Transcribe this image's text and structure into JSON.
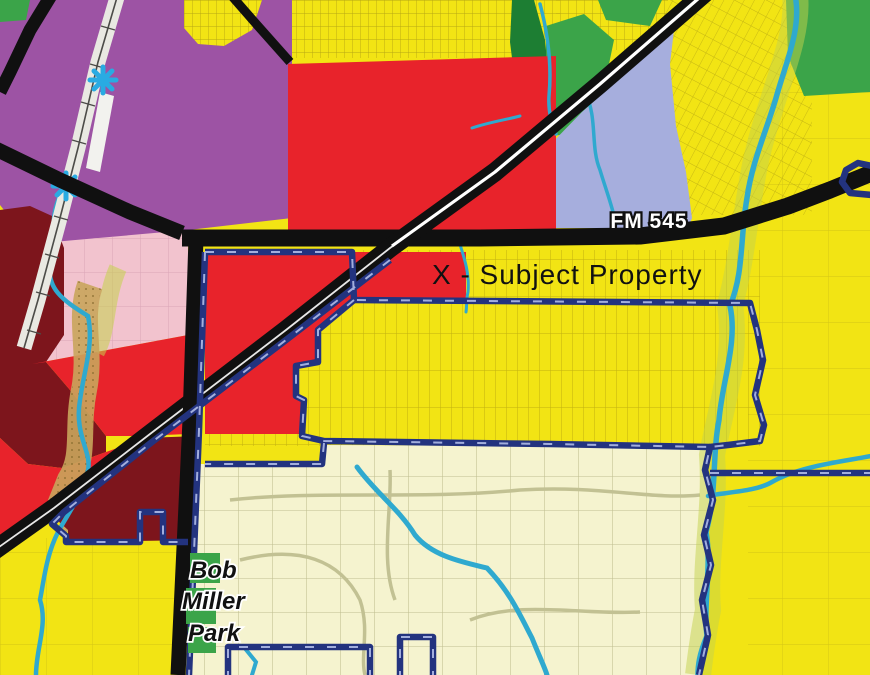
{
  "map": {
    "type": "zoning-land-use-map",
    "labels": {
      "highway": "FM 545",
      "subject": "X - Subject Property",
      "park_line1": "Bob",
      "park_line2": "Miller",
      "park_line3": "Park"
    },
    "markers": {
      "rail_crossing_icon": "blue-asterisk",
      "boundary_style": "navy-dashed-city-limit"
    },
    "colors": {
      "purple": "#9d53a4",
      "red": "#e8232b",
      "maroon": "#7d151c",
      "pink": "#f2c3ce",
      "yellow": "#f2e414",
      "paleYellow": "#f5f3cf",
      "green": "#3ba449",
      "darkGreen": "#1d7e33",
      "periwinkle": "#a6aedd",
      "creek": "#2fa9cf",
      "navy": "#23337f",
      "navyDash": "#b9c4ee",
      "road": "#101010",
      "rail": "#e9e9e2",
      "railLine": "#4c4c48",
      "tan": "#c9a55c",
      "tanDot": "#8a6d2f",
      "floodGreen": "#c4d24b",
      "asterisk": "#29abe2",
      "white": "#ffffff",
      "labelDark": "#111111",
      "parcelSmall": "#9f8d12",
      "parcelMed": "#a79510",
      "parcelPale": "#b9b88a",
      "parcelPink": "#d49db1"
    }
  }
}
